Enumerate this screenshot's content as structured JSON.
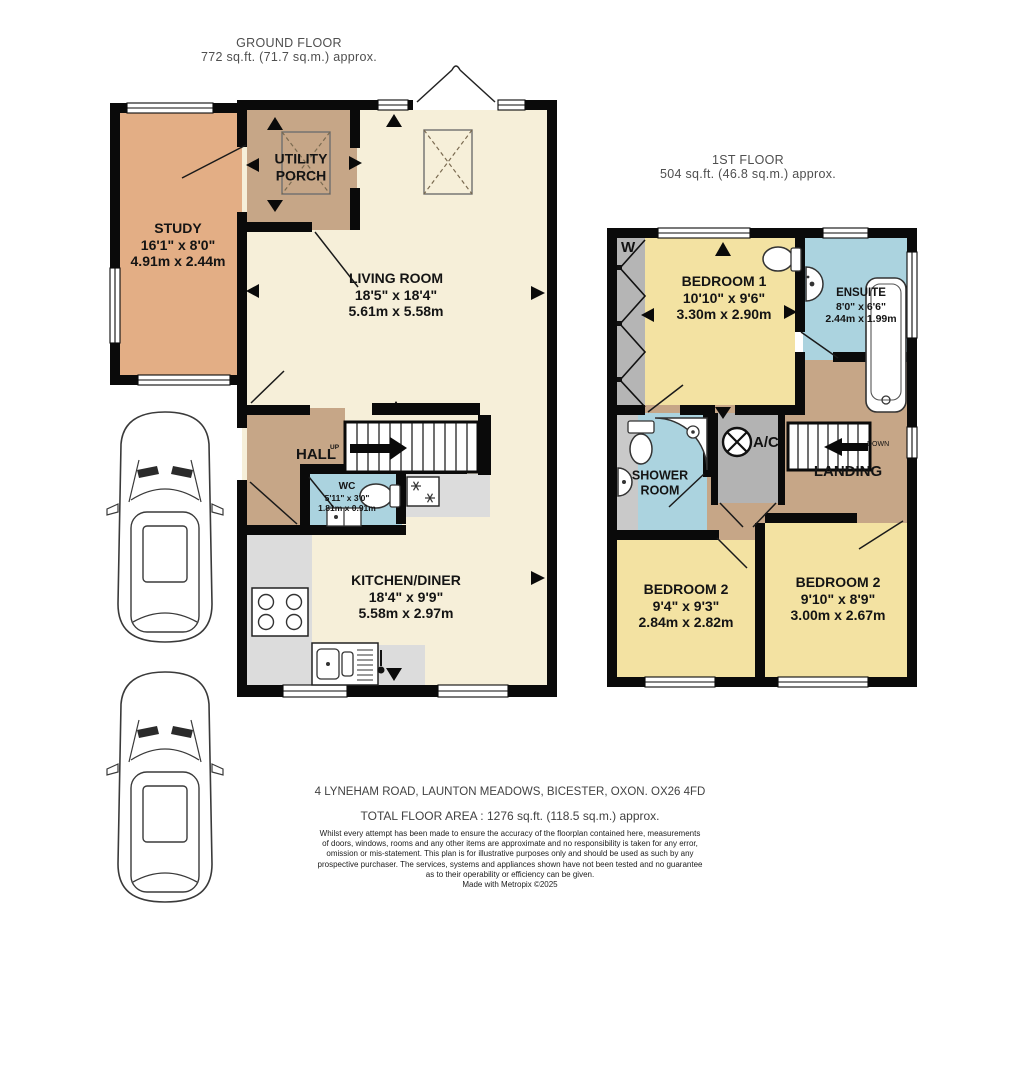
{
  "floors": {
    "ground": {
      "title": "GROUND FLOOR",
      "area": "772 sq.ft. (71.7 sq.m.) approx.",
      "labels": {
        "up": "UP"
      },
      "rooms": {
        "study": {
          "name": "STUDY",
          "imperial": "16'1\" x 8'0\"",
          "metric": "4.91m x 2.44m"
        },
        "utility_porch": {
          "name": "UTILITY PORCH"
        },
        "living_room": {
          "name": "LIVING ROOM",
          "imperial": "18'5\" x 18'4\"",
          "metric": "5.61m x 5.58m"
        },
        "hall": {
          "name": "HALL"
        },
        "wc": {
          "name": "WC",
          "imperial": "5'11\" x 3'0\"",
          "metric": "1.81m x 0.91m"
        },
        "kitchen_diner": {
          "name": "KITCHEN/DINER",
          "imperial": "18'4\" x 9'9\"",
          "metric": "5.58m x 2.97m"
        }
      }
    },
    "first": {
      "title": "1ST FLOOR",
      "area": "504 sq.ft. (46.8 sq.m.) approx.",
      "labels": {
        "wardrobe": "W",
        "down": "DOWN"
      },
      "rooms": {
        "bedroom1": {
          "name": "BEDROOM 1",
          "imperial": "10'10\" x 9'6\"",
          "metric": "3.30m x 2.90m"
        },
        "ensuite": {
          "name": "ENSUITE",
          "imperial": "8'0\" x 6'6\"",
          "metric": "2.44m x 1.99m"
        },
        "shower_room": {
          "name": "SHOWER ROOM"
        },
        "ac": {
          "name": "A/C"
        },
        "landing": {
          "name": "LANDING"
        },
        "bedroom2_left": {
          "name": "BEDROOM 2",
          "imperial": "9'4\" x 9'3\"",
          "metric": "2.84m x 2.82m"
        },
        "bedroom2_right": {
          "name": "BEDROOM 2",
          "imperial": "9'10\" x 8'9\"",
          "metric": "3.00m x 2.67m"
        }
      }
    }
  },
  "footer": {
    "address": "4 LYNEHAM ROAD, LAUNTON MEADOWS, BICESTER, OXON. OX26 4FD",
    "total_area": "TOTAL FLOOR AREA : 1276 sq.ft. (118.5 sq.m.) approx.",
    "disclaimer_lines": [
      "Whilst every attempt has been made to ensure the accuracy of the floorplan contained here, measurements",
      "of doors, windows, rooms and any other items are approximate and no responsibility is taken for any error,",
      "omission or mis-statement. This plan is for illustrative purposes only and should be used as such by any",
      "prospective purchaser. The services, systems and appliances shown have not been tested and no guarantee",
      "as to their operability or efficiency can be given."
    ],
    "credit": "Made with Metropix ©2025"
  },
  "colors": {
    "wall": "#0a0a0a",
    "room_cream": "#F6EFD9",
    "room_tan": "#C6A687",
    "room_salmon": "#E3AE85",
    "room_yellow": "#F3E2A2",
    "room_blue": "#ABD3DF",
    "room_gray": "#B3B3B3",
    "counter_gray": "#DCDCDC"
  }
}
